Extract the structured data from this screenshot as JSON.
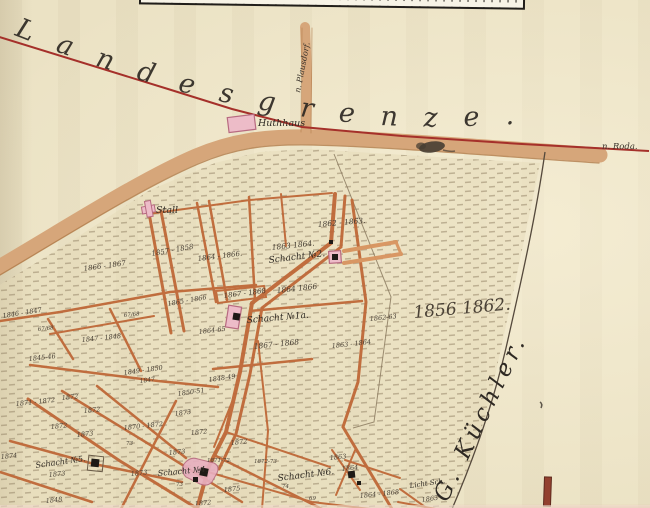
{
  "labels": {
    "landesgrenze": "Landesgrenze.",
    "kuechler": "G. Küchler.",
    "n_roda": "n. Roda.",
    "n_plausdorf": "n. Plausdorf.",
    "huthhaus": "Huthhaus",
    "stall": "Stall",
    "big_years": "1856  1862."
  },
  "shafts": [
    "Schacht №2.",
    "Schacht №1a.",
    "Schacht №5.",
    "Schacht №4.",
    "Schacht №6.",
    "Licht Sch."
  ],
  "years": [
    "1857 - 1858",
    "1864 - 1866.",
    "1866 - 1867",
    "1862 - 1863.",
    "1863  1864.",
    "1864  1866",
    "1867 - 1868",
    "1864-65",
    "1865 - 1866",
    "1867 - 1868",
    "1862-63",
    "1863 - 1864",
    "1846 - 1847",
    "1847 - 1848",
    "1845-46",
    "1849 - 1850",
    "1847",
    "67/68",
    "67/68",
    "1850-51",
    "1848-49",
    "1873",
    "1871 - 1872",
    "1872",
    "1872",
    "1872",
    "1870 - 1872",
    "1873",
    "1874",
    "73",
    "1873",
    "1873",
    "1848",
    "1872",
    "1872",
    "1873",
    "1871-72",
    "1872-73",
    "73",
    "1875",
    "1872",
    "74",
    "69",
    "1863",
    "1864",
    "1864 - 1868",
    "1863"
  ],
  "colors": {
    "paper": "#ebe2c4",
    "road": "#d6a67a",
    "road_edge": "#b07a48",
    "state_border_red": "#a5302a",
    "parcel_line": "#bf6838",
    "building_pink": "#edbcc8",
    "building_pink_stroke": "#b76a80",
    "ink": "#3b342c",
    "hatch": "#97866a"
  }
}
